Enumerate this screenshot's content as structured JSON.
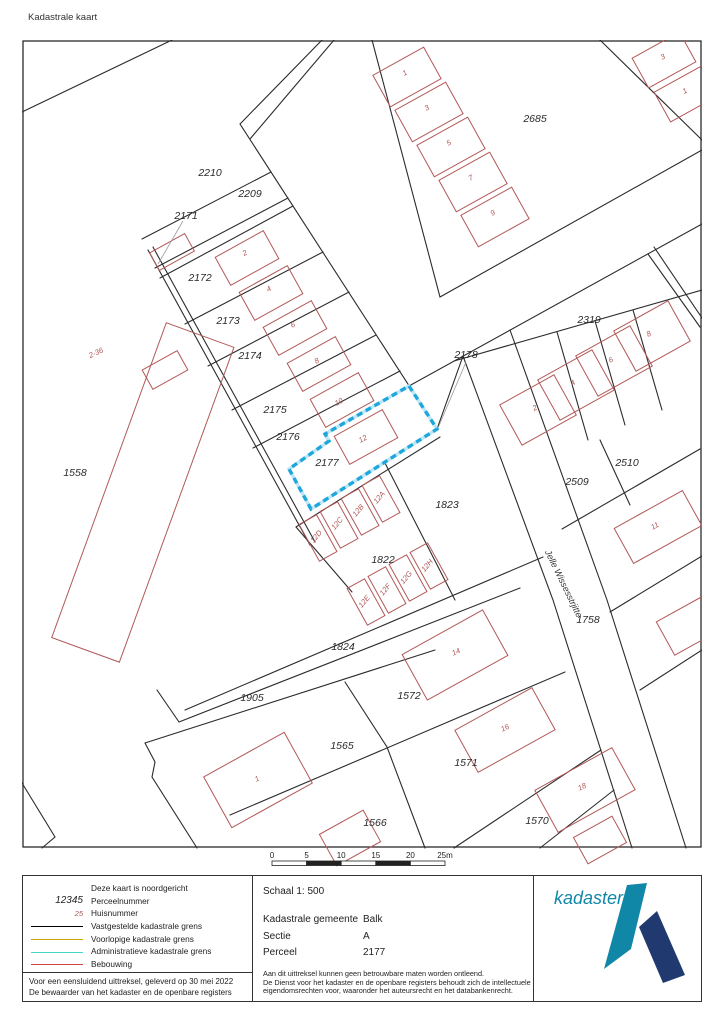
{
  "page_title": "Kadastrale kaart",
  "map": {
    "highlight": {
      "parcel": "2177",
      "color": "#1ea7dc",
      "underlay": "#bfe6f5"
    },
    "street_label": {
      "text": "Jelle Wissesstrjitte",
      "x": 561,
      "y": 585,
      "rotation": 64
    },
    "parcel_labels": [
      {
        "id": "2685",
        "x": 535,
        "y": 122
      },
      {
        "id": "2210",
        "x": 210,
        "y": 176
      },
      {
        "id": "2209",
        "x": 250,
        "y": 197
      },
      {
        "id": "2171",
        "x": 186,
        "y": 219
      },
      {
        "id": "2172",
        "x": 200,
        "y": 281
      },
      {
        "id": "2173",
        "x": 228,
        "y": 324
      },
      {
        "id": "2174",
        "x": 250,
        "y": 359
      },
      {
        "id": "2175",
        "x": 275,
        "y": 413
      },
      {
        "id": "2176",
        "x": 288,
        "y": 440
      },
      {
        "id": "2177",
        "x": 327,
        "y": 466
      },
      {
        "id": "2178",
        "x": 466,
        "y": 358
      },
      {
        "id": "2319",
        "x": 589,
        "y": 323
      },
      {
        "id": "2510",
        "x": 627,
        "y": 466
      },
      {
        "id": "2509",
        "x": 577,
        "y": 485
      },
      {
        "id": "1823",
        "x": 447,
        "y": 508
      },
      {
        "id": "1822",
        "x": 383,
        "y": 563
      },
      {
        "id": "1824",
        "x": 343,
        "y": 650
      },
      {
        "id": "1905",
        "x": 252,
        "y": 701
      },
      {
        "id": "1565",
        "x": 342,
        "y": 749
      },
      {
        "id": "1566",
        "x": 375,
        "y": 826
      },
      {
        "id": "1572",
        "x": 409,
        "y": 699
      },
      {
        "id": "1571",
        "x": 466,
        "y": 766
      },
      {
        "id": "1570",
        "x": 537,
        "y": 824
      },
      {
        "id": "1758",
        "x": 588,
        "y": 623
      },
      {
        "id": "1558",
        "x": 75,
        "y": 476
      }
    ],
    "house_numbers": [
      {
        "n": "2",
        "x": 246,
        "y": 255,
        "r": -29
      },
      {
        "n": "4",
        "x": 270,
        "y": 291,
        "r": -29
      },
      {
        "n": "6",
        "x": 294,
        "y": 327,
        "r": -29
      },
      {
        "n": "8",
        "x": 318,
        "y": 363,
        "r": -29
      },
      {
        "n": "10",
        "x": 340,
        "y": 404,
        "r": -29
      },
      {
        "n": "12",
        "x": 364,
        "y": 441,
        "r": -29
      },
      {
        "n": "1",
        "x": 406,
        "y": 75,
        "r": -29
      },
      {
        "n": "3",
        "x": 428,
        "y": 110,
        "r": -29
      },
      {
        "n": "5",
        "x": 450,
        "y": 145,
        "r": -29
      },
      {
        "n": "7",
        "x": 472,
        "y": 180,
        "r": -29
      },
      {
        "n": "9",
        "x": 494,
        "y": 215,
        "r": -29
      },
      {
        "n": "3",
        "x": 664,
        "y": 59,
        "r": -29
      },
      {
        "n": "1",
        "x": 686,
        "y": 93,
        "r": -29
      },
      {
        "n": "2",
        "x": 536,
        "y": 410,
        "r": -29
      },
      {
        "n": "4",
        "x": 574,
        "y": 385,
        "r": -29
      },
      {
        "n": "6",
        "x": 612,
        "y": 362,
        "r": -29
      },
      {
        "n": "8",
        "x": 650,
        "y": 336,
        "r": -29
      },
      {
        "n": "11",
        "x": 656,
        "y": 528,
        "r": -29
      },
      {
        "n": "12A",
        "x": 381,
        "y": 499,
        "r": -50
      },
      {
        "n": "12B",
        "x": 360,
        "y": 512,
        "r": -50
      },
      {
        "n": "12C",
        "x": 339,
        "y": 525,
        "r": -50
      },
      {
        "n": "12D",
        "x": 318,
        "y": 538,
        "r": -50
      },
      {
        "n": "12E",
        "x": 366,
        "y": 603,
        "r": -50
      },
      {
        "n": "12F",
        "x": 387,
        "y": 591,
        "r": -50
      },
      {
        "n": "12G",
        "x": 408,
        "y": 579,
        "r": -50
      },
      {
        "n": "12H",
        "x": 429,
        "y": 567,
        "r": -50
      },
      {
        "n": "1",
        "x": 258,
        "y": 781,
        "r": -25
      },
      {
        "n": "14",
        "x": 457,
        "y": 654,
        "r": -25
      },
      {
        "n": "16",
        "x": 506,
        "y": 730,
        "r": -25
      },
      {
        "n": "18",
        "x": 583,
        "y": 789,
        "r": -25
      },
      {
        "n": "2-36",
        "x": 97,
        "y": 355,
        "r": -25
      }
    ],
    "scale_bar": {
      "ticks": [
        "0",
        "5",
        "10",
        "15",
        "20",
        "25m"
      ]
    }
  },
  "footer": {
    "legend": {
      "items": [
        {
          "type": "none",
          "label": "Deze kaart is noordgericht"
        },
        {
          "type": "text",
          "sample": "12345",
          "label": "Perceelnummer"
        },
        {
          "type": "text-red",
          "sample": "25",
          "label": "Huisnummer"
        },
        {
          "type": "line",
          "color": "#000000",
          "label": "Vastgestelde kadastrale grens"
        },
        {
          "type": "line",
          "color": "#c8a400",
          "label": "Voorlopige kadastrale grens"
        },
        {
          "type": "line",
          "color": "#45d8c8",
          "label": "Administratieve kadastrale grens"
        },
        {
          "type": "line",
          "color": "#cc4444",
          "label": "Bebouwing"
        }
      ],
      "footnote1": "Voor een eensluidend uittreksel, geleverd op 30 mei 2022",
      "footnote2": "De bewaarder van het kadaster en de openbare registers"
    },
    "details": {
      "schaal": "Schaal 1: 500",
      "rows": [
        {
          "label": "Kadastrale gemeente",
          "value": "Balk"
        },
        {
          "label": "Sectie",
          "value": "A"
        },
        {
          "label": "Perceel",
          "value": "2177"
        }
      ],
      "disclaimer": [
        "Aan dit uittreksel kunnen geen betrouwbare maten worden ontleend.",
        "De Dienst voor het kadaster en de openbare registers behoudt zich de intellectuele",
        "eigendomsrechten voor, waaronder het auteursrecht en het databankenrecht."
      ]
    },
    "logo": {
      "text": "kadaster",
      "teal": "#1187a8",
      "navy": "#203a70"
    }
  }
}
